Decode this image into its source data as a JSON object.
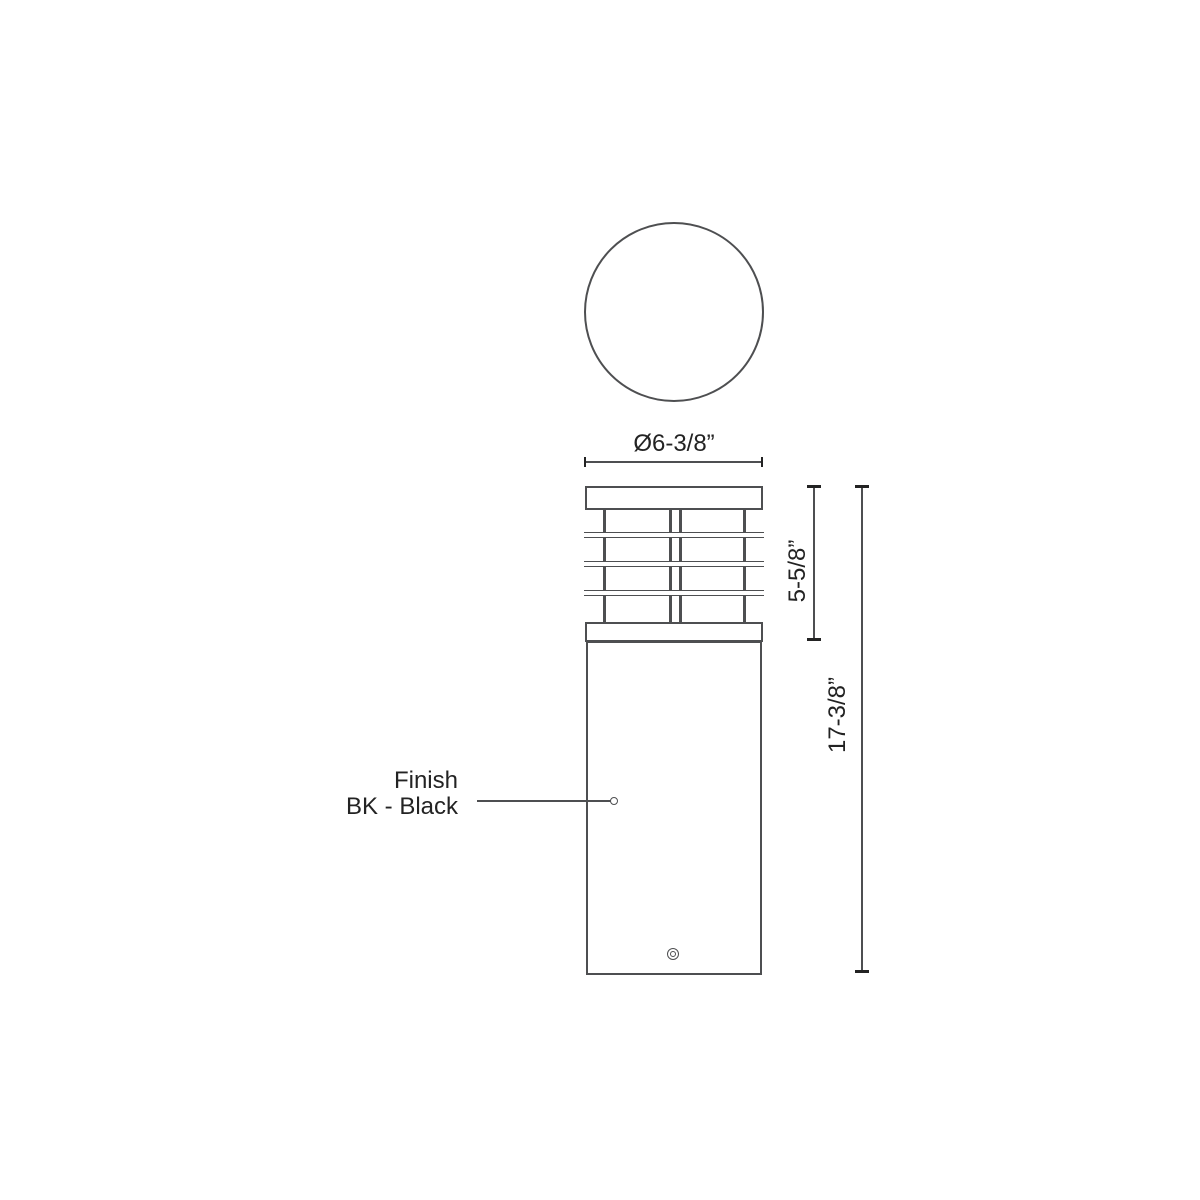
{
  "drawing": {
    "dimensions": {
      "diameter_label": "Ø6-3/8”",
      "louver_height_label": "5-5/8”",
      "overall_height_label": "17-3/8”"
    },
    "finish": {
      "line1": "Finish",
      "line2": "BK - Black"
    },
    "colors": {
      "line": "#4E4F51",
      "tick": "#232323",
      "text": "#232323",
      "background": "#FFFFFF"
    }
  }
}
